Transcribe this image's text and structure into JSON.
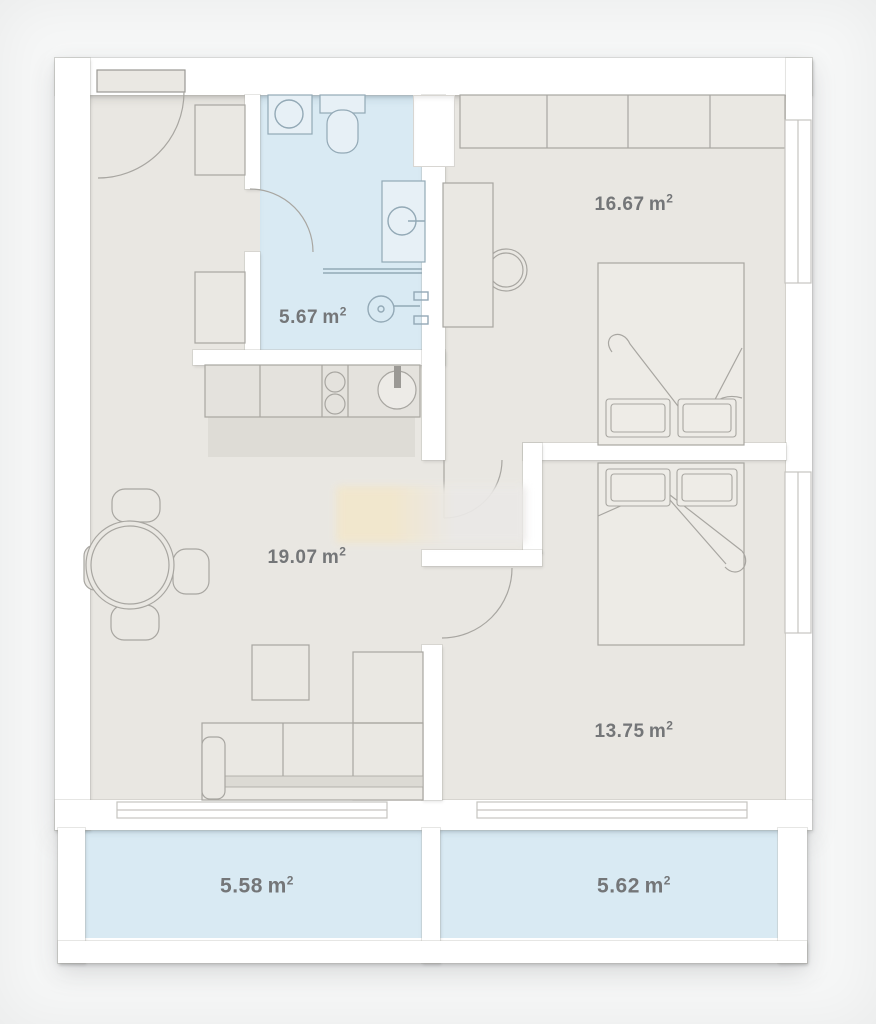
{
  "title": "Two-bedroom apartment floor plan",
  "unit": {
    "symbol": "m",
    "sup": "2"
  },
  "rooms": {
    "bedroom_top": {
      "name": "bedroom-top",
      "area": "16.67"
    },
    "bathroom": {
      "name": "bathroom",
      "area": "5.67"
    },
    "living": {
      "name": "living-room",
      "area": "19.07"
    },
    "bedroom_bottom": {
      "name": "bedroom-bottom",
      "area": "13.75"
    },
    "balcony_left": {
      "name": "balcony-left",
      "area": "5.58"
    },
    "balcony_right": {
      "name": "balcony-right",
      "area": "5.62"
    }
  },
  "colors": {
    "bg": "#f6f7f7",
    "wall": "#ffffff",
    "floor": "#e9e7e2",
    "wet": "#d9eaf3",
    "line": "#a8a6a1",
    "label": "#747678",
    "furn": "#eae8e3",
    "counter": "#e4e2dd",
    "countershadow": "#dedcd6",
    "fixture": "#93a9b6",
    "fixturefill": "#e7f0f6",
    "window": "#c6c4c0",
    "wmcream": "#f2e7cc",
    "wmgray": "#ebe9e7"
  }
}
